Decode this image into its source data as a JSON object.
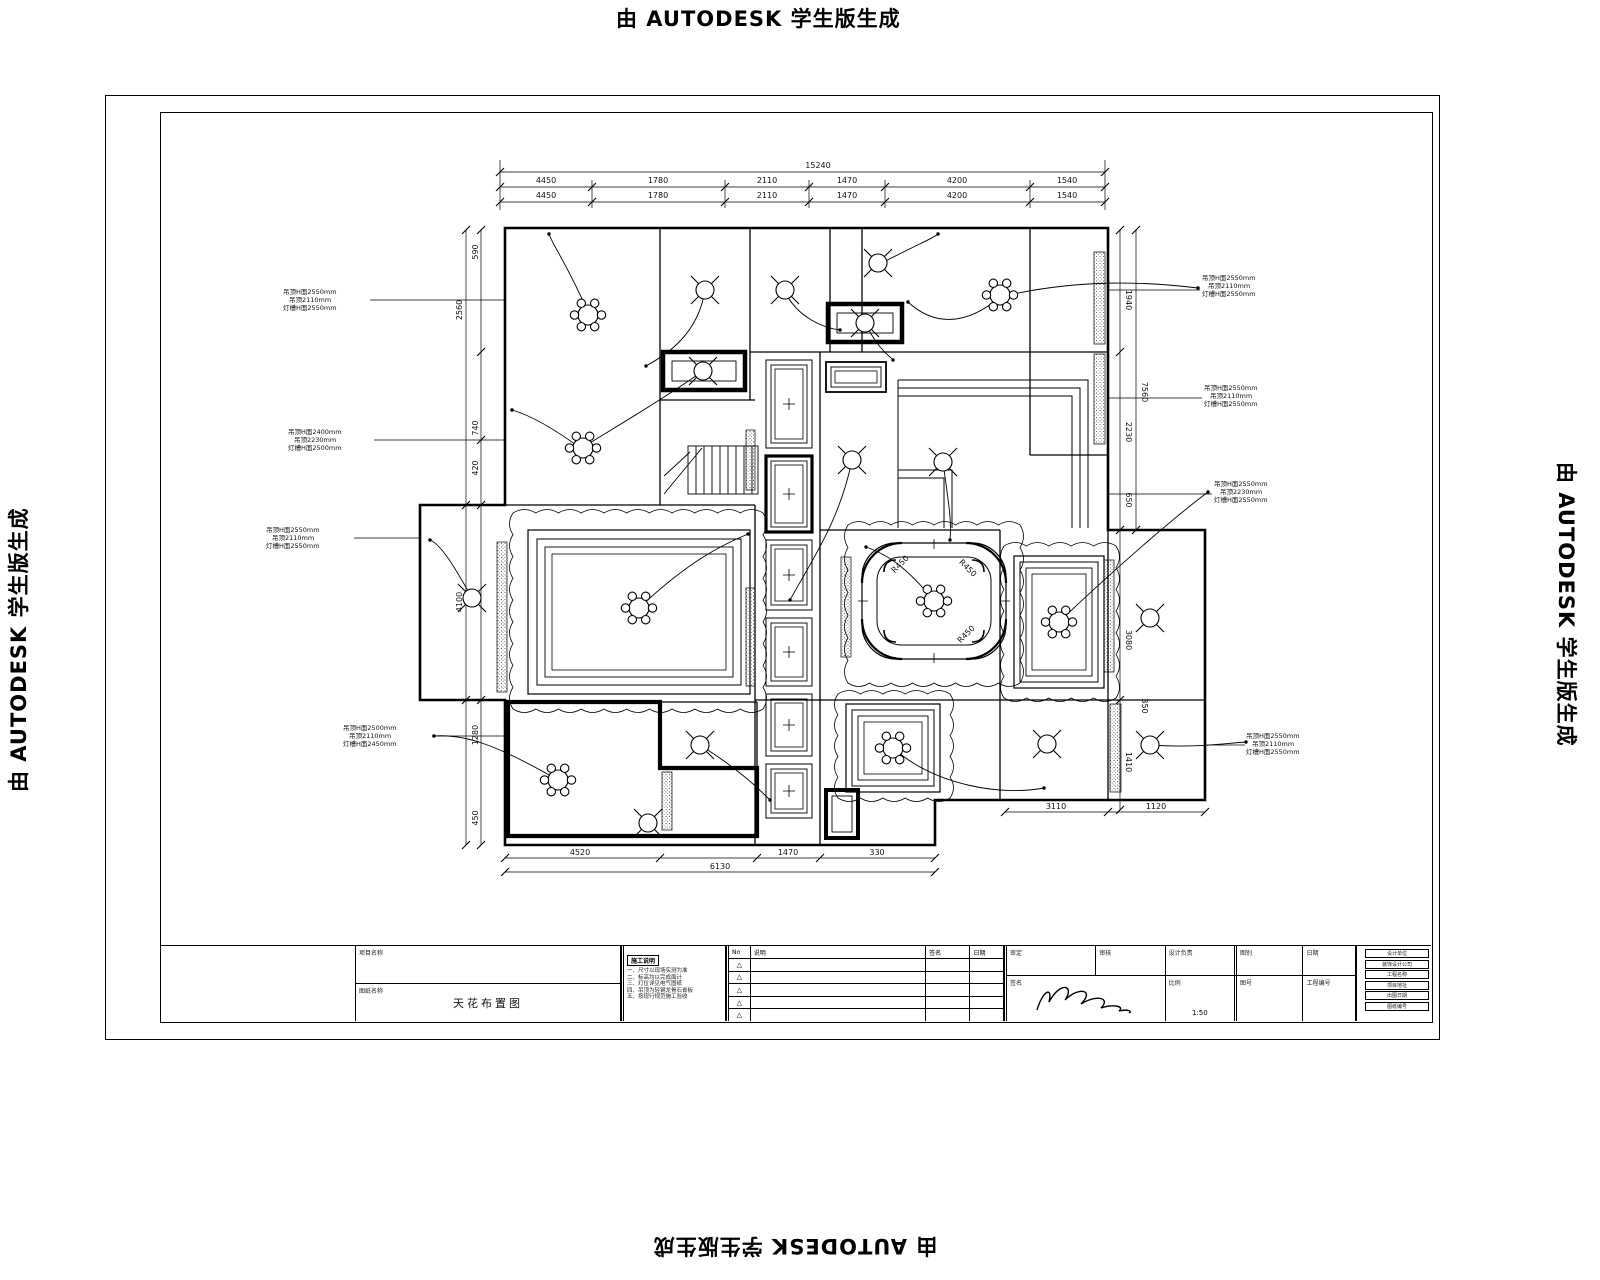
{
  "watermark": {
    "text": "由 AUTODESK 学生版生成"
  },
  "drawing": {
    "annotations": [
      {
        "x": 283,
        "y": 288,
        "lines": [
          "吊顶H面2550mm",
          "吊顶2110mm",
          "灯槽H面2550mm"
        ]
      },
      {
        "x": 288,
        "y": 428,
        "lines": [
          "吊顶H面2400mm",
          "吊顶2230mm",
          "灯槽H面2500mm"
        ]
      },
      {
        "x": 266,
        "y": 526,
        "lines": [
          "吊顶H面2550mm",
          "吊顶2110mm",
          "灯槽H面2550mm"
        ]
      },
      {
        "x": 343,
        "y": 724,
        "lines": [
          "吊顶H面2500mm",
          "吊顶2110mm",
          "灯槽H面2450mm"
        ]
      },
      {
        "x": 1202,
        "y": 274,
        "lines": [
          "吊顶H面2550mm",
          "吊顶2110mm",
          "灯槽H面2550mm"
        ]
      },
      {
        "x": 1204,
        "y": 384,
        "lines": [
          "吊顶H面2550mm",
          "吊顶2110mm",
          "灯槽H面2550mm"
        ]
      },
      {
        "x": 1214,
        "y": 480,
        "lines": [
          "吊顶H面2550mm",
          "吊顶2230mm",
          "灯槽H面2550mm"
        ]
      },
      {
        "x": 1246,
        "y": 732,
        "lines": [
          "吊顶H面2550mm",
          "吊顶2110mm",
          "灯槽H面2550mm"
        ]
      }
    ],
    "dim_texts": [
      {
        "t": "15240",
        "x": 818,
        "y": 168,
        "r": 0
      },
      {
        "t": "4450",
        "x": 546,
        "y": 183,
        "r": 0
      },
      {
        "t": "1780",
        "x": 658,
        "y": 183,
        "r": 0
      },
      {
        "t": "2110",
        "x": 767,
        "y": 183,
        "r": 0
      },
      {
        "t": "1470",
        "x": 847,
        "y": 183,
        "r": 0
      },
      {
        "t": "4200",
        "x": 957,
        "y": 183,
        "r": 0
      },
      {
        "t": "1540",
        "x": 1067,
        "y": 183,
        "r": 0
      },
      {
        "t": "4450",
        "x": 546,
        "y": 198,
        "r": 0
      },
      {
        "t": "1780",
        "x": 658,
        "y": 198,
        "r": 0
      },
      {
        "t": "2110",
        "x": 767,
        "y": 198,
        "r": 0
      },
      {
        "t": "1470",
        "x": 847,
        "y": 198,
        "r": 0
      },
      {
        "t": "4200",
        "x": 957,
        "y": 198,
        "r": 0
      },
      {
        "t": "1540",
        "x": 1067,
        "y": 198,
        "r": 0
      },
      {
        "t": "590",
        "x": 478,
        "y": 252,
        "r": -90
      },
      {
        "t": "2560",
        "x": 462,
        "y": 310,
        "r": -90
      },
      {
        "t": "740",
        "x": 478,
        "y": 428,
        "r": -90
      },
      {
        "t": "420",
        "x": 478,
        "y": 468,
        "r": -90
      },
      {
        "t": "4100",
        "x": 462,
        "y": 602,
        "r": -90
      },
      {
        "t": "1280",
        "x": 478,
        "y": 735,
        "r": -90
      },
      {
        "t": "450",
        "x": 478,
        "y": 818,
        "r": -90
      },
      {
        "t": "1940",
        "x": 1126,
        "y": 300,
        "r": 90
      },
      {
        "t": "2230",
        "x": 1126,
        "y": 432,
        "r": 90
      },
      {
        "t": "650",
        "x": 1126,
        "y": 500,
        "r": 90
      },
      {
        "t": "3080",
        "x": 1126,
        "y": 640,
        "r": 90
      },
      {
        "t": "1410",
        "x": 1126,
        "y": 762,
        "r": 90
      },
      {
        "t": "7560",
        "x": 1142,
        "y": 392,
        "r": 90
      },
      {
        "t": "350",
        "x": 1142,
        "y": 706,
        "r": 90
      },
      {
        "t": "4520",
        "x": 580,
        "y": 855,
        "r": 0
      },
      {
        "t": "1470",
        "x": 788,
        "y": 855,
        "r": 0
      },
      {
        "t": "330",
        "x": 877,
        "y": 855,
        "r": 0
      },
      {
        "t": "6130",
        "x": 720,
        "y": 869,
        "r": 0
      },
      {
        "t": "3110",
        "x": 1056,
        "y": 809,
        "r": 0
      },
      {
        "t": "1120",
        "x": 1156,
        "y": 809,
        "r": 0
      },
      {
        "t": "R450",
        "x": 902,
        "y": 566,
        "r": -45
      },
      {
        "t": "R450",
        "x": 968,
        "y": 636,
        "r": -45
      },
      {
        "t": "R450",
        "x": 966,
        "y": 570,
        "r": 45
      }
    ]
  },
  "titleblock": {
    "project_label": "项目名称",
    "drawing_label": "图纸名称",
    "drawing_name": "天花布置图",
    "notes_title": "施工说明",
    "notes_lines": [
      "一、尺寸以现场实测为准",
      "二、标高均以完成面计",
      "三、灯位详见电气图纸",
      "四、吊顶为轻钢龙骨石膏板",
      "五、按现行规范施工验收"
    ],
    "revision": {
      "headers": [
        "No",
        "说明",
        "签名",
        "日期"
      ],
      "symbol": "△"
    },
    "approval": {
      "row1": [
        {
          "label": "审定",
          "value": ""
        },
        {
          "label": "审核",
          "value": ""
        },
        {
          "label": "设计负责",
          "value": ""
        },
        {
          "label": "图别",
          "value": ""
        },
        {
          "label": "日期",
          "value": ""
        }
      ],
      "row2": [
        {
          "label": "签名",
          "value": ""
        },
        {
          "label": "比例",
          "value": "1:50"
        },
        {
          "label": "图号",
          "value": ""
        },
        {
          "label": "工程编号",
          "value": ""
        }
      ]
    },
    "company_rows": [
      "设计单位",
      "装饰设计公司",
      "工程名称",
      "项目地址",
      "出图日期",
      "图纸编号"
    ]
  }
}
